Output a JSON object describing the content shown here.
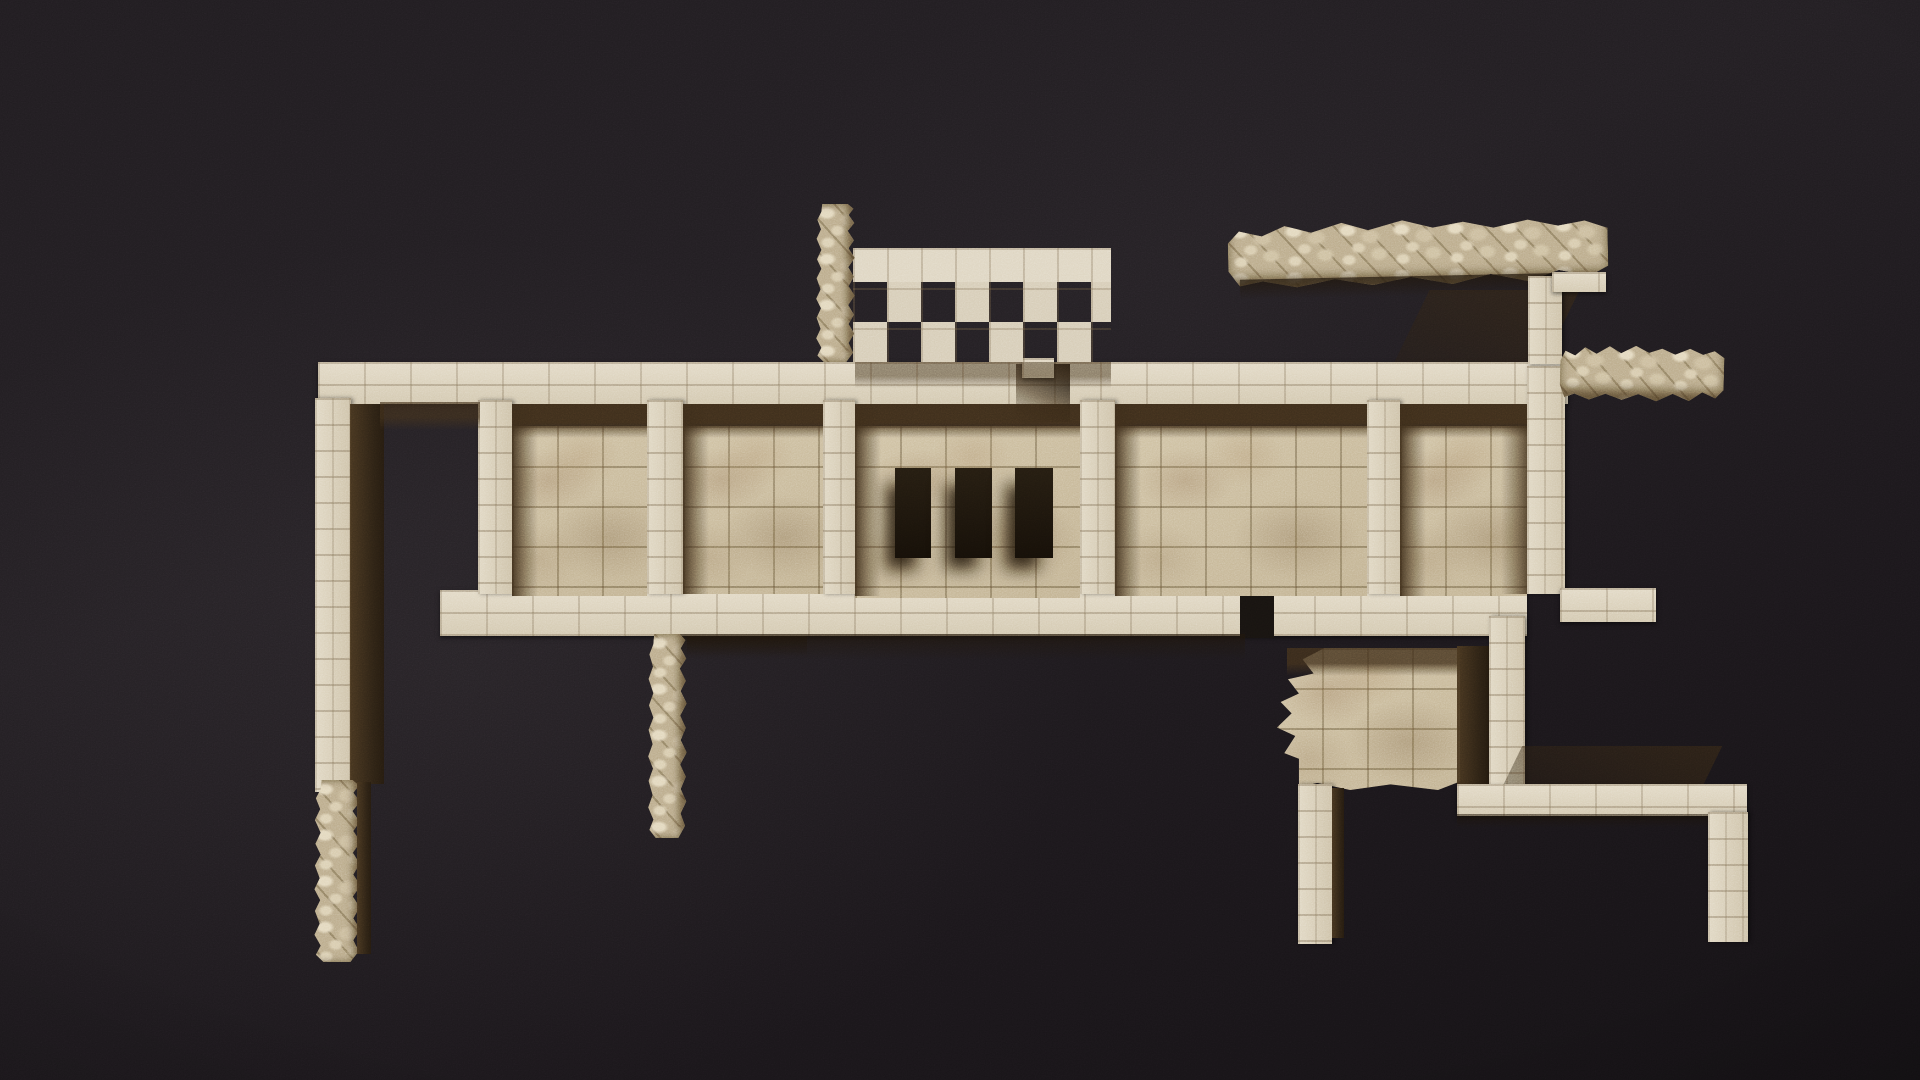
{
  "scene": {
    "description": "Top-down photograph of excavated ancient stone ruins lit by raking sun against near-black ground: a long band of roofless rooms with ashlar walls and paved floors, a checkerboard lattice wall and rubble pillar above, a collapsed rubble wall at the upper right, and detached pillars and a paved platform below.",
    "canvas": {
      "width": 1920,
      "height": 1080
    },
    "palette": {
      "background": "#1d191d",
      "stone_light": "#ddd3bd",
      "stone_mid": "#cdc1a7",
      "floor_stone": "#c7b797",
      "mortar": "#7a674a",
      "shadow_brown": "#42321f",
      "shadow_deep": "#241a0e",
      "rubble_stone": "#c4b494"
    },
    "elements": [
      {
        "id": "band-top-wall",
        "type": "wall-h",
        "x": 318,
        "y": 362,
        "w": 1250,
        "h": 42
      },
      {
        "id": "band-bottom-wall",
        "type": "wall-h",
        "x": 440,
        "y": 590,
        "w": 1087,
        "h": 46
      },
      {
        "id": "divider-1",
        "type": "wall-v",
        "x": 478,
        "y": 400,
        "w": 34,
        "h": 194
      },
      {
        "id": "divider-2",
        "type": "wall-v",
        "x": 647,
        "y": 400,
        "w": 36,
        "h": 194
      },
      {
        "id": "divider-3",
        "type": "wall-v",
        "x": 823,
        "y": 400,
        "w": 32,
        "h": 194
      },
      {
        "id": "divider-4",
        "type": "wall-v",
        "x": 1080,
        "y": 400,
        "w": 35,
        "h": 194
      },
      {
        "id": "divider-5",
        "type": "wall-v",
        "x": 1367,
        "y": 400,
        "w": 33,
        "h": 194
      },
      {
        "id": "right-outer-wall",
        "type": "wall-v",
        "x": 1527,
        "y": 366,
        "w": 38,
        "h": 228
      },
      {
        "id": "right-corner-arm",
        "type": "wall-h",
        "x": 1560,
        "y": 588,
        "w": 96,
        "h": 34
      },
      {
        "id": "left-outer-wall",
        "type": "wall-v",
        "x": 315,
        "y": 398,
        "w": 36,
        "h": 394
      },
      {
        "id": "left-wall-inner-face",
        "type": "shadow-v",
        "x": 350,
        "y": 404,
        "w": 34,
        "h": 380
      },
      {
        "id": "left-wall-rubble",
        "type": "rubble-v",
        "x": 313,
        "y": 780,
        "w": 48,
        "h": 182
      },
      {
        "id": "left-wall-rubble-shadow",
        "type": "shadow-v",
        "x": 357,
        "y": 782,
        "w": 14,
        "h": 172
      },
      {
        "id": "floor-room-b",
        "type": "floor",
        "x": 512,
        "y": 426,
        "w": 135,
        "h": 170
      },
      {
        "id": "floor-room-c",
        "type": "floor",
        "x": 683,
        "y": 426,
        "w": 140,
        "h": 168
      },
      {
        "id": "floor-room-d",
        "type": "floor",
        "x": 855,
        "y": 426,
        "w": 225,
        "h": 172
      },
      {
        "id": "floor-room-e",
        "type": "floor",
        "x": 1115,
        "y": 426,
        "w": 252,
        "h": 170
      },
      {
        "id": "floor-room-f",
        "type": "floor",
        "x": 1400,
        "y": 426,
        "w": 127,
        "h": 170
      },
      {
        "id": "room-a-top-shade",
        "type": "shadow-top",
        "x": 380,
        "y": 402,
        "w": 100,
        "h": 28,
        "op": 0.7
      },
      {
        "id": "room-b-top-shade",
        "type": "shadow-top",
        "x": 512,
        "y": 404,
        "w": 135,
        "h": 34
      },
      {
        "id": "room-b-left-shade",
        "type": "shadow-left",
        "x": 512,
        "y": 404,
        "w": 26,
        "h": 192
      },
      {
        "id": "room-c-top-shade",
        "type": "shadow-top",
        "x": 683,
        "y": 404,
        "w": 140,
        "h": 34
      },
      {
        "id": "room-c-left-shade",
        "type": "shadow-left",
        "x": 683,
        "y": 404,
        "w": 26,
        "h": 190
      },
      {
        "id": "room-d-top-shade",
        "type": "shadow-top",
        "x": 855,
        "y": 404,
        "w": 225,
        "h": 34
      },
      {
        "id": "room-d-left-shade",
        "type": "shadow-left",
        "x": 855,
        "y": 404,
        "w": 26,
        "h": 192
      },
      {
        "id": "room-e-top-shade",
        "type": "shadow-top",
        "x": 1115,
        "y": 404,
        "w": 252,
        "h": 34
      },
      {
        "id": "room-e-left-shade",
        "type": "shadow-left",
        "x": 1115,
        "y": 404,
        "w": 26,
        "h": 192
      },
      {
        "id": "room-f-top-shade",
        "type": "shadow-top",
        "x": 1400,
        "y": 404,
        "w": 127,
        "h": 34
      },
      {
        "id": "room-f-left-shade",
        "type": "shadow-left",
        "x": 1400,
        "y": 404,
        "w": 26,
        "h": 192
      },
      {
        "id": "room-f-right-shade",
        "type": "shadow-right",
        "x": 1501,
        "y": 426,
        "w": 26,
        "h": 168
      },
      {
        "id": "window-slot-1",
        "type": "void-slot",
        "x": 895,
        "y": 468,
        "w": 36,
        "h": 90
      },
      {
        "id": "window-slot-2",
        "type": "void-slot",
        "x": 955,
        "y": 468,
        "w": 37,
        "h": 90
      },
      {
        "id": "window-slot-3",
        "type": "void-slot",
        "x": 1015,
        "y": 468,
        "w": 38,
        "h": 90
      },
      {
        "id": "doorway-notch",
        "type": "shadow-door",
        "x": 1016,
        "y": 364,
        "w": 54,
        "h": 58
      },
      {
        "id": "doorway-lintel",
        "type": "wall-h",
        "x": 1022,
        "y": 358,
        "w": 32,
        "h": 20
      },
      {
        "id": "lattice-under-shade",
        "type": "shadow-top",
        "x": 855,
        "y": 362,
        "w": 256,
        "h": 26,
        "op": 0.55
      },
      {
        "id": "lattice-wall",
        "type": "checker",
        "x": 853,
        "y": 248,
        "w": 258,
        "h": 114
      },
      {
        "id": "top-pillar",
        "type": "rubble-v",
        "x": 815,
        "y": 204,
        "w": 40,
        "h": 158
      },
      {
        "id": "rubble-wall-ne",
        "type": "rubble-h",
        "x": 1228,
        "y": 220,
        "w": 380,
        "h": 66,
        "rot": -1.2
      },
      {
        "id": "rubble-ne-under-shade",
        "type": "shadow-h",
        "x": 1240,
        "y": 276,
        "w": 356,
        "h": 20,
        "rot": -1.2,
        "op": 0.85
      },
      {
        "id": "rubble-ne-cast-shadow",
        "type": "shadow-skew",
        "x": 1412,
        "y": 290,
        "w": 150,
        "h": 72,
        "op": 0.8
      },
      {
        "id": "ne-connector-wall",
        "type": "wall-v",
        "x": 1528,
        "y": 276,
        "w": 34,
        "h": 88
      },
      {
        "id": "ne-connector-arm",
        "type": "wall-h",
        "x": 1552,
        "y": 272,
        "w": 54,
        "h": 20
      },
      {
        "id": "rubble-fragment-east",
        "type": "rubble-h",
        "x": 1560,
        "y": 346,
        "w": 164,
        "h": 56,
        "rot": 1.5
      },
      {
        "id": "bottom-wall-notch",
        "type": "void",
        "x": 1240,
        "y": 596,
        "w": 34,
        "h": 42
      },
      {
        "id": "under-band-shadow",
        "type": "shadow-h",
        "x": 660,
        "y": 634,
        "w": 585,
        "h": 26,
        "op": 0.75
      },
      {
        "id": "mid-pillar",
        "type": "rubble-v",
        "x": 647,
        "y": 634,
        "w": 40,
        "h": 204
      },
      {
        "id": "mid-pillar-cast-shadow",
        "type": "shadow-h",
        "x": 687,
        "y": 636,
        "w": 120,
        "h": 20,
        "op": 0.8
      },
      {
        "id": "platform-se",
        "type": "floor-rough",
        "x": 1277,
        "y": 648,
        "w": 183,
        "h": 142
      },
      {
        "id": "platform-se-top-shade",
        "type": "shadow-top",
        "x": 1287,
        "y": 648,
        "w": 173,
        "h": 28,
        "op": 0.85
      },
      {
        "id": "platform-right-shade",
        "type": "shadow-v",
        "x": 1457,
        "y": 646,
        "w": 32,
        "h": 144
      },
      {
        "id": "platform-right-wall",
        "type": "wall-v",
        "x": 1489,
        "y": 616,
        "w": 36,
        "h": 174
      },
      {
        "id": "bar-pre-shadow",
        "type": "shadow-skew",
        "x": 1512,
        "y": 746,
        "w": 200,
        "h": 42,
        "op": 0.85
      },
      {
        "id": "bottom-bar",
        "type": "wall-h",
        "x": 1457,
        "y": 784,
        "w": 290,
        "h": 32
      },
      {
        "id": "bottom-bar-under-shade",
        "type": "shadow-h",
        "x": 1457,
        "y": 814,
        "w": 290,
        "h": 14,
        "op": 0.7
      },
      {
        "id": "pillar-sw-of-platform",
        "type": "wall-v",
        "x": 1298,
        "y": 784,
        "w": 34,
        "h": 160
      },
      {
        "id": "pillar-sw-shade",
        "type": "shadow-v",
        "x": 1332,
        "y": 788,
        "w": 12,
        "h": 150
      },
      {
        "id": "pillar-se",
        "type": "wall-v",
        "x": 1708,
        "y": 812,
        "w": 40,
        "h": 130
      }
    ]
  }
}
